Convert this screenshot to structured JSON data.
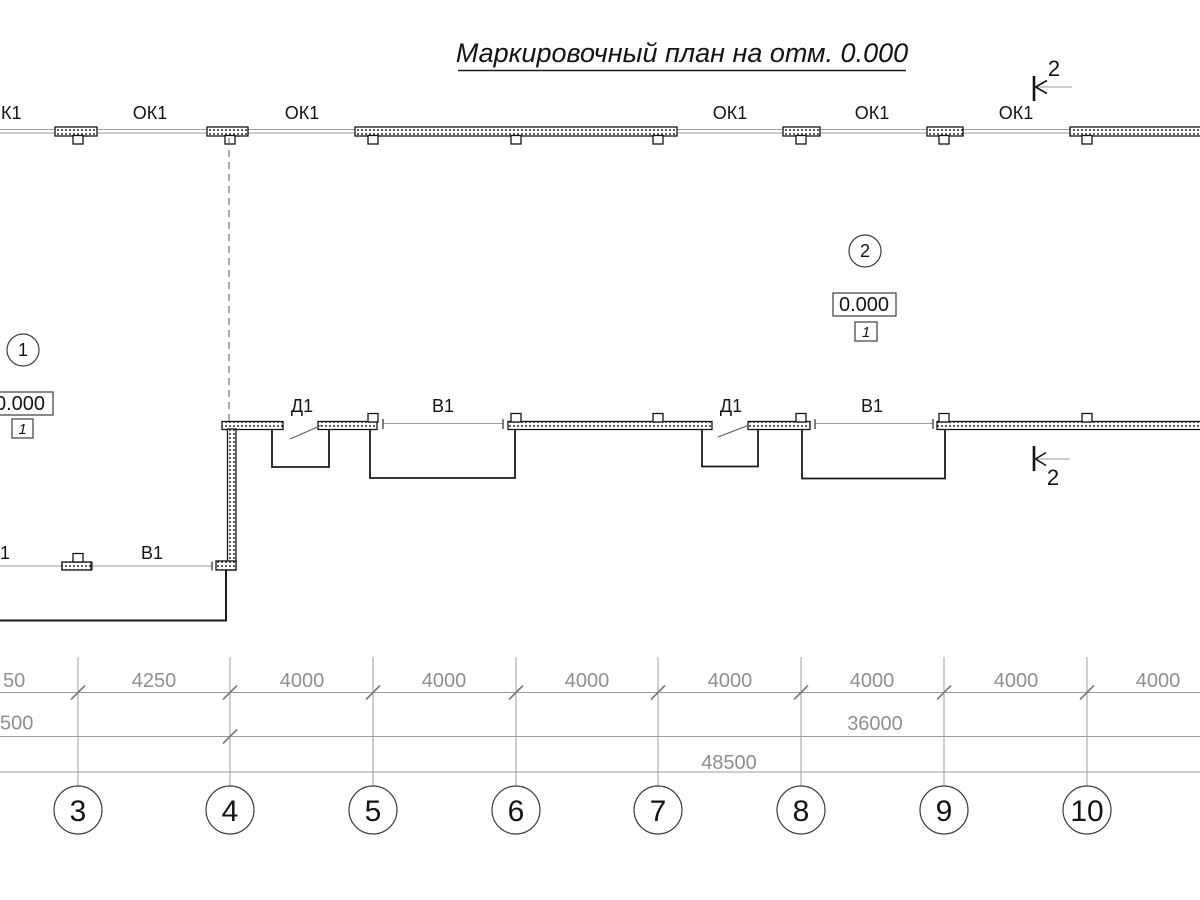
{
  "title": "Маркировочный план на отм. 0.000",
  "top_wall": {
    "window_labels": [
      "К1",
      "ОК1",
      "ОК1",
      "ОК1",
      "ОК1",
      "ОК1"
    ]
  },
  "middle_wall": {
    "door_labels": [
      "Д1",
      "Д1"
    ],
    "window_labels": [
      "В1",
      "В1"
    ]
  },
  "left_wall": {
    "window_labels": [
      "1",
      "В1"
    ]
  },
  "markers": {
    "node1": {
      "number": "1",
      "elevation": "0.000",
      "ref": "1"
    },
    "node2": {
      "number": "2",
      "elevation": "0.000",
      "ref": "1"
    }
  },
  "section_marks": {
    "top": "2",
    "bottom": "2"
  },
  "dimensions": {
    "row1": [
      "50",
      "4250",
      "4000",
      "4000",
      "4000",
      "4000",
      "4000",
      "4000",
      "4000"
    ],
    "row2": [
      "500",
      "36000"
    ],
    "row3": [
      "48500"
    ]
  },
  "grid": {
    "bubbles": [
      "3",
      "4",
      "5",
      "6",
      "7",
      "8",
      "9",
      "10"
    ]
  }
}
